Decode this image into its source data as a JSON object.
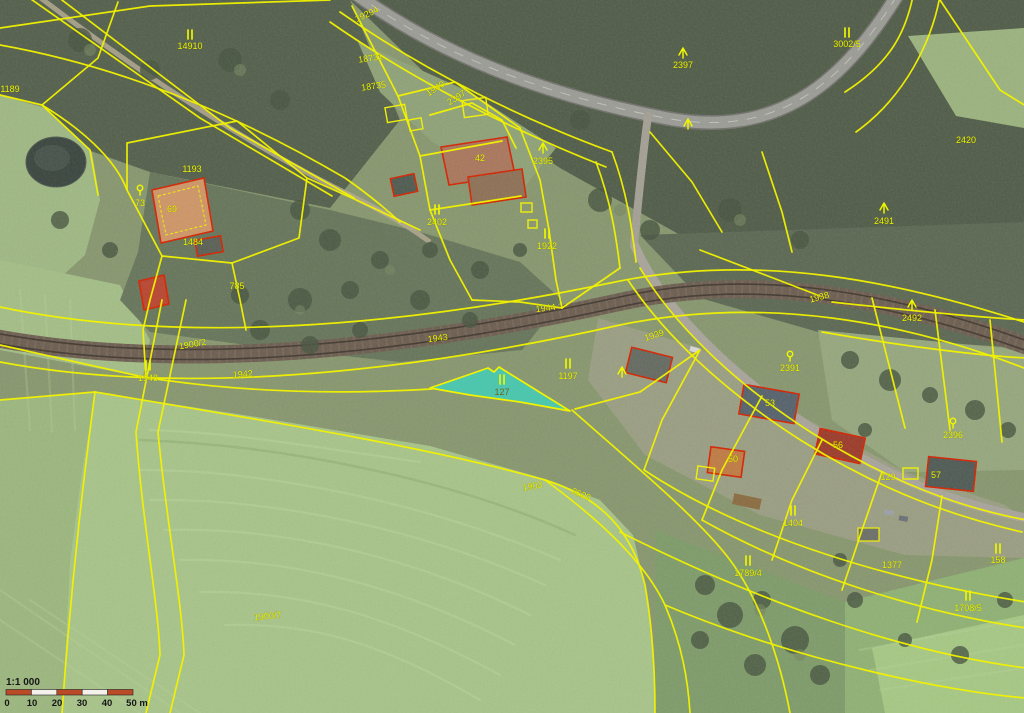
{
  "map": {
    "type": "cadastral-orthophoto-map",
    "scale": {
      "ratio_text": "1:1 000",
      "ticks": [
        "0",
        "10",
        "20",
        "30",
        "40",
        "50 m"
      ],
      "tick_x": [
        7,
        32,
        57,
        82,
        107,
        137
      ]
    },
    "highlight": {
      "parcel_number": "127",
      "land_use_symbol": "II"
    },
    "colors": {
      "parcel_line": "#F2F200",
      "label_text": "#EDF500",
      "highlight_fill": "#3BD6C3",
      "highlight_number": "#6E6420",
      "building_outline": "#D42300",
      "scale_bar_orange": "#BB4A26",
      "scale_bar_white": "#F4F1EA",
      "scale_text": "#161616"
    },
    "labels": [
      {
        "x": 190,
        "y": 36,
        "sym": "ii"
      },
      {
        "x": 190,
        "y": 49,
        "t": "14910"
      },
      {
        "x": 10,
        "y": 92,
        "t": "1189"
      },
      {
        "x": 368,
        "y": 17,
        "t": "19294",
        "rot": -25
      },
      {
        "x": 371,
        "y": 61,
        "t": "18731",
        "rot": -8
      },
      {
        "x": 374,
        "y": 89,
        "t": "18735",
        "rot": -8
      },
      {
        "x": 437,
        "y": 91,
        "t": "1940",
        "rot": -33
      },
      {
        "x": 458,
        "y": 100,
        "t": "2397",
        "rot": -33
      },
      {
        "x": 480,
        "y": 161,
        "t": "42"
      },
      {
        "x": 847,
        "y": 34,
        "sym": "ii"
      },
      {
        "x": 847,
        "y": 47,
        "t": "3002/5"
      },
      {
        "x": 683,
        "y": 54,
        "sym": "tree"
      },
      {
        "x": 683,
        "y": 68,
        "t": "2397"
      },
      {
        "x": 688,
        "y": 125,
        "sym": "tree"
      },
      {
        "x": 543,
        "y": 149,
        "sym": "tree"
      },
      {
        "x": 543,
        "y": 164,
        "t": "2395"
      },
      {
        "x": 966,
        "y": 143,
        "t": "2420"
      },
      {
        "x": 884,
        "y": 209,
        "sym": "tree"
      },
      {
        "x": 884,
        "y": 224,
        "t": "2491"
      },
      {
        "x": 912,
        "y": 306,
        "sym": "tree"
      },
      {
        "x": 912,
        "y": 321,
        "t": "2492"
      },
      {
        "x": 820,
        "y": 300,
        "t": "1938",
        "rot": -15
      },
      {
        "x": 546,
        "y": 311,
        "t": "1944",
        "rot": -7
      },
      {
        "x": 438,
        "y": 341,
        "t": "1943",
        "rot": -7
      },
      {
        "x": 243,
        "y": 377,
        "t": "1942",
        "rot": -4
      },
      {
        "x": 148,
        "y": 367,
        "sym": "ii"
      },
      {
        "x": 148,
        "y": 381,
        "t": "1948"
      },
      {
        "x": 193,
        "y": 347,
        "t": "1900/2",
        "rot": -10
      },
      {
        "x": 140,
        "y": 191,
        "sym": "fruit"
      },
      {
        "x": 140,
        "y": 206,
        "t": "73"
      },
      {
        "x": 192,
        "y": 172,
        "t": "1193"
      },
      {
        "x": 172,
        "y": 212,
        "t": "69"
      },
      {
        "x": 193,
        "y": 245,
        "t": "1484"
      },
      {
        "x": 237,
        "y": 289,
        "t": "785"
      },
      {
        "x": 437,
        "y": 211,
        "sym": "ii"
      },
      {
        "x": 437,
        "y": 225,
        "t": "2402"
      },
      {
        "x": 547,
        "y": 235,
        "sym": "ii"
      },
      {
        "x": 547,
        "y": 249,
        "t": "1922"
      },
      {
        "x": 502,
        "y": 381,
        "sym": "ii"
      },
      {
        "x": 502,
        "y": 395,
        "t": "127",
        "c": "#6E6420"
      },
      {
        "x": 568,
        "y": 365,
        "sym": "ii"
      },
      {
        "x": 568,
        "y": 379,
        "t": "1197"
      },
      {
        "x": 655,
        "y": 338,
        "t": "1939",
        "rot": -18
      },
      {
        "x": 622,
        "y": 373,
        "sym": "tree"
      },
      {
        "x": 790,
        "y": 357,
        "sym": "fruit"
      },
      {
        "x": 790,
        "y": 371,
        "t": "2391"
      },
      {
        "x": 953,
        "y": 424,
        "sym": "fruit"
      },
      {
        "x": 953,
        "y": 438,
        "t": "2396"
      },
      {
        "x": 770,
        "y": 406,
        "t": "53"
      },
      {
        "x": 838,
        "y": 448,
        "t": "56"
      },
      {
        "x": 733,
        "y": 462,
        "t": "50"
      },
      {
        "x": 888,
        "y": 480,
        "t": "129"
      },
      {
        "x": 936,
        "y": 478,
        "t": "57"
      },
      {
        "x": 793,
        "y": 512,
        "sym": "ii"
      },
      {
        "x": 793,
        "y": 526,
        "t": "1404"
      },
      {
        "x": 748,
        "y": 562,
        "sym": "ii"
      },
      {
        "x": 748,
        "y": 576,
        "t": "1789/4"
      },
      {
        "x": 998,
        "y": 550,
        "sym": "ii"
      },
      {
        "x": 998,
        "y": 563,
        "t": "158"
      },
      {
        "x": 968,
        "y": 597,
        "sym": "ii"
      },
      {
        "x": 968,
        "y": 611,
        "t": "1708/5"
      },
      {
        "x": 892,
        "y": 568,
        "t": "1377"
      },
      {
        "x": 533,
        "y": 489,
        "t": "1903",
        "rot": -10
      },
      {
        "x": 580,
        "y": 497,
        "t": "2620",
        "rot": 22
      },
      {
        "x": 268,
        "y": 619,
        "t": "1900/7",
        "rot": -6
      }
    ]
  }
}
